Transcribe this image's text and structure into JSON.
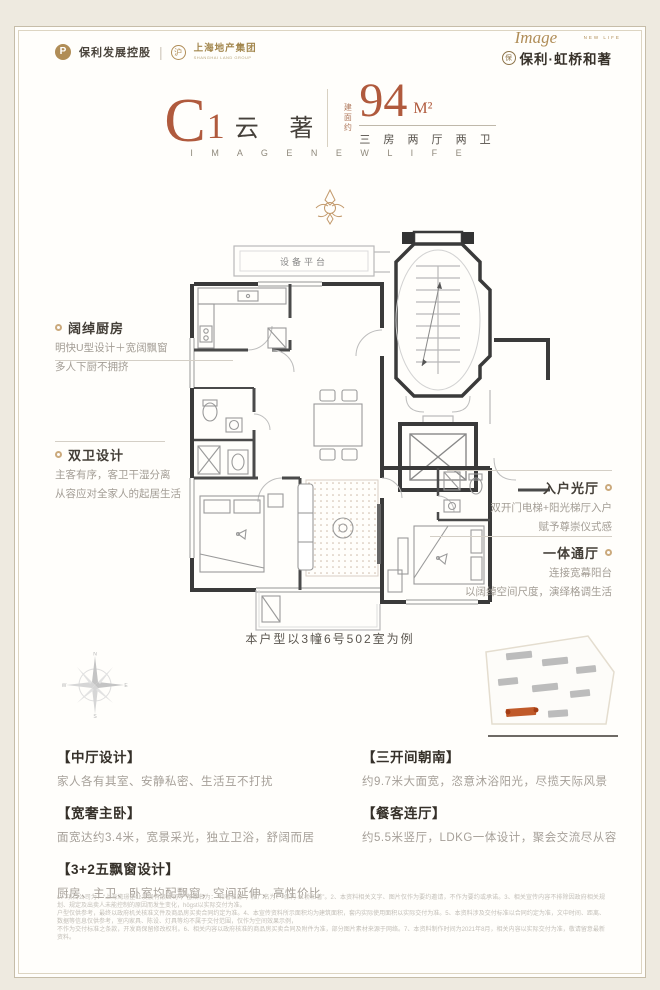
{
  "colors": {
    "accent_terracotta": "#b05a3d",
    "brand_gold": "#b08d57",
    "text_dark": "#3c362e",
    "text_gray": "#a39d95",
    "wall_dark": "#3a3a3a",
    "site_highlight": "#c05a2a",
    "background_cream": "#eeeae0",
    "card_white": "#fffefb"
  },
  "header": {
    "brand_left_mark": "P",
    "brand_left_primary": "保利发展控股",
    "brand_separator": "|",
    "brand_left_secondary_mark": "沪",
    "brand_left_secondary": "上海地产集团",
    "brand_left_secondary_sub": "SHANGHAI LAND GROUP",
    "brand_right_script": "Image",
    "brand_right_script_sub": "NEW LIFE",
    "brand_right_seal": "保",
    "brand_right_name": "保利·虹桥和著"
  },
  "title": {
    "plan_letter": "C",
    "plan_number": "1",
    "plan_name": "云 著",
    "area_prefix": "建面约",
    "area_value": "94",
    "area_unit": "M²",
    "rooms": "三 房 两 厅 两 卫",
    "slogan": "I M A G E   N E W   L I F E"
  },
  "floorplan": {
    "platform_label": "设备平台",
    "example_note": "本户型以3幢6号502室为例"
  },
  "callouts": {
    "left": [
      {
        "title": "阔绰厨房",
        "line1": "明快U型设计＋宽阔飘窗",
        "line2": "多人下厨不拥挤"
      },
      {
        "title": "双卫设计",
        "line1": "主客有序，客卫干湿分离",
        "line2": "从容应对全家人的起居生活"
      }
    ],
    "right": [
      {
        "title": "入户光厅",
        "line1": "双开门电梯+阳光梯厅入户",
        "line2": "赋予尊崇仪式感"
      },
      {
        "title": "一体通厅",
        "line1": "连接宽幕阳台",
        "line2": "以阔绰空间尺度，演绎格调生活"
      }
    ]
  },
  "features": {
    "left": [
      {
        "title": "【中厅设计】",
        "desc": "家人各有其室、安静私密、生活互不打扰"
      },
      {
        "title": "【宽奢主卧】",
        "desc": "面宽达约3.4米，宽景采光，独立卫浴，舒阔而居"
      },
      {
        "title": "【3+2五飘窗设计】",
        "desc": "厨房、主卫、卧室均配飘窗，空间延伸，高性价比"
      }
    ],
    "right": [
      {
        "title": "【三开间朝南】",
        "desc": "约9.7米大面宽，恣意沐浴阳光，尽揽天际风景"
      },
      {
        "title": "【餐客连厅】",
        "desc": "约5.5米竖厅，LDKG一体设计，聚会交流尽从容"
      }
    ]
  },
  "disclaimer": {
    "line1": "1、项目公司为：“上海湾璟企业发展有限公司”，备案名为：“和著名邸”，推广名为：“保利·虹桥和著”。2、本资料相关文字、图片仅作为要约邀请，不作为要约或承诺。3、相关宣传内容不排除因政府相关规划、规定及出卖人未能控制的原因而发生变化，högst以实际交付为准。",
    "line2": "户型仅供参考，最终以政府机关核准文件及商品房买卖合同约定为准。4、本宣传资料所示面积均为建筑面积，套内实际使用面积以实际交付为准。5、本资料涉及交付标准以合同约定为准，文中时间、距离、数据等信息仅供参考，室内家具、陈设、灯具等均不属于交付范围，仅作为空间效果示例，",
    "line3": "不作为交付标准之条款，开发商保留修改权利。6、相关内容以政府核准的商品房买卖合同及附件为准，部分图片素材来源于网络。7、本资料制作时间为2021年8月，相关内容以实际交付为准，敬请留意最新资料。"
  }
}
